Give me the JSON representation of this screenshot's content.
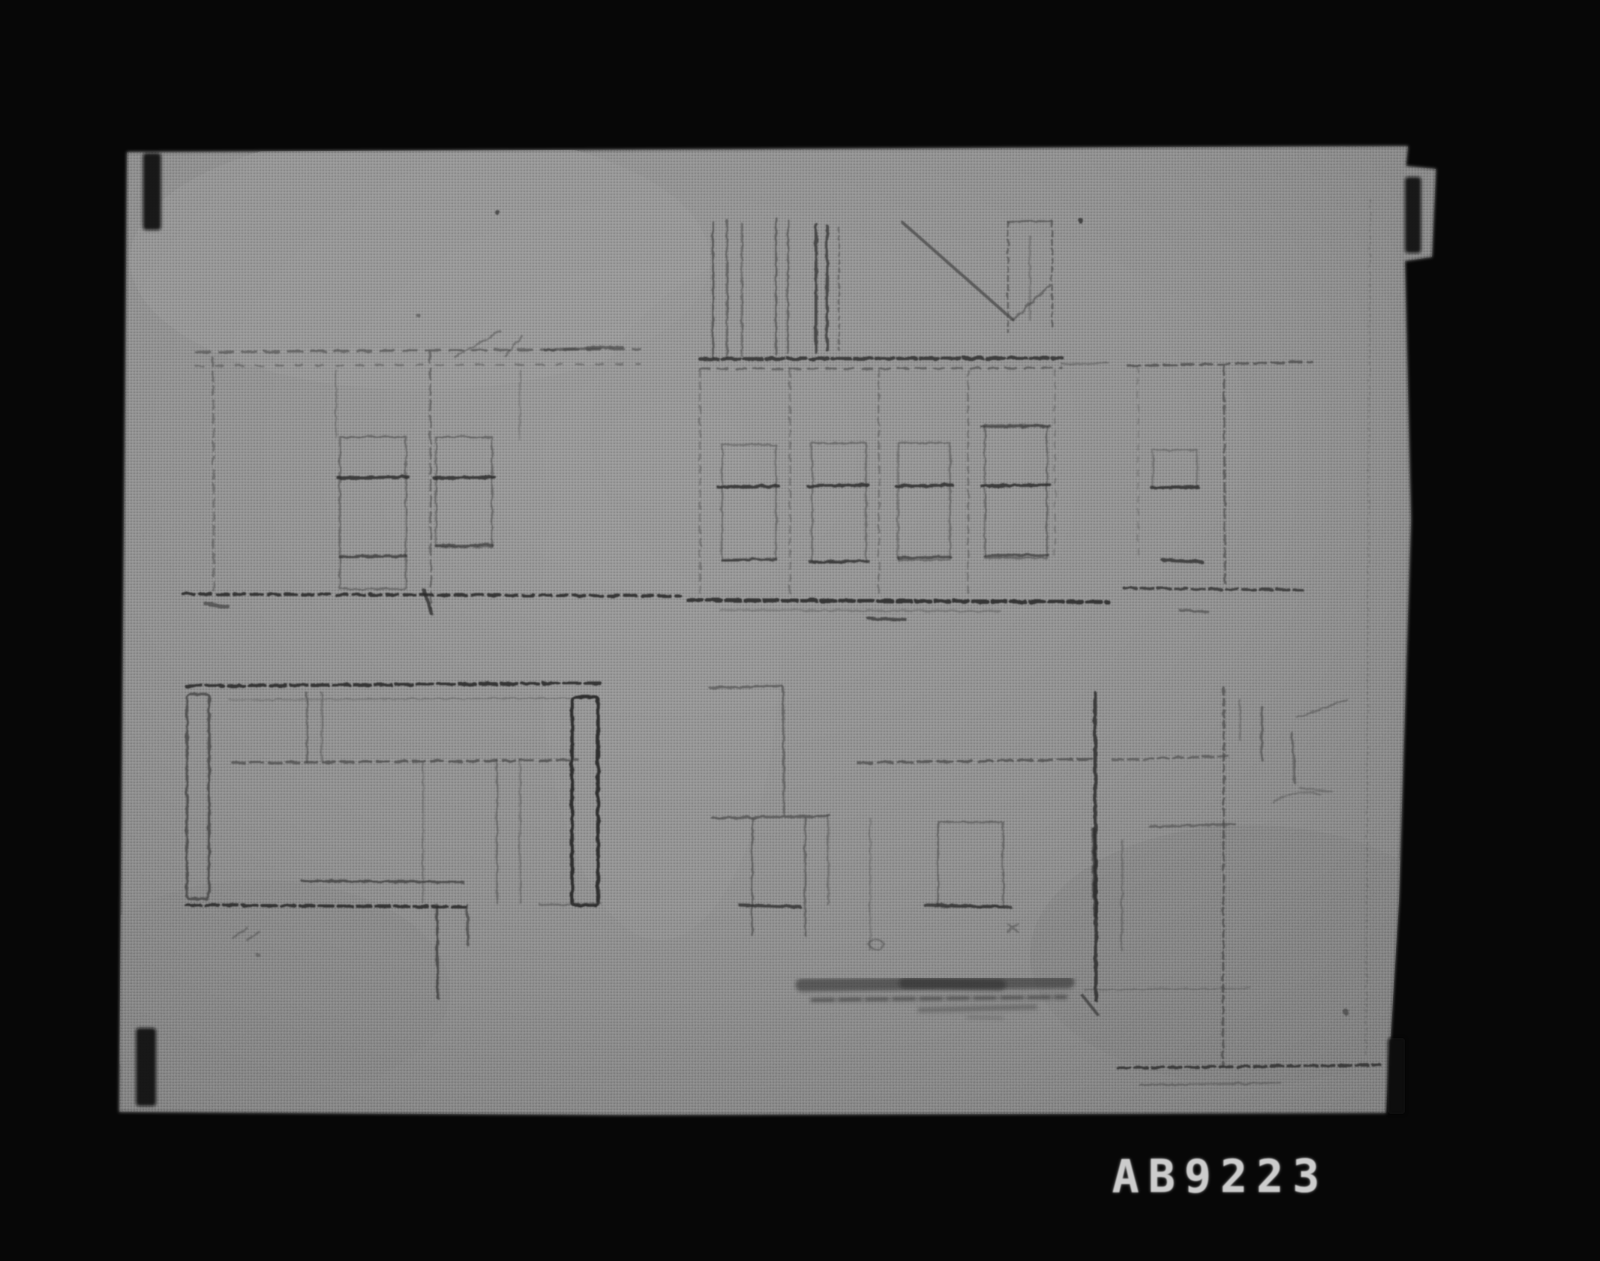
{
  "photo": {
    "id_label": "AB9223",
    "colors": {
      "background": "#070707",
      "paper": "#8f8f8f",
      "paper_light": "#9b9b9b",
      "paper_dark": "#7d7d7d",
      "pencil": "#3e3e3e",
      "id_text": "#cccccc"
    }
  }
}
